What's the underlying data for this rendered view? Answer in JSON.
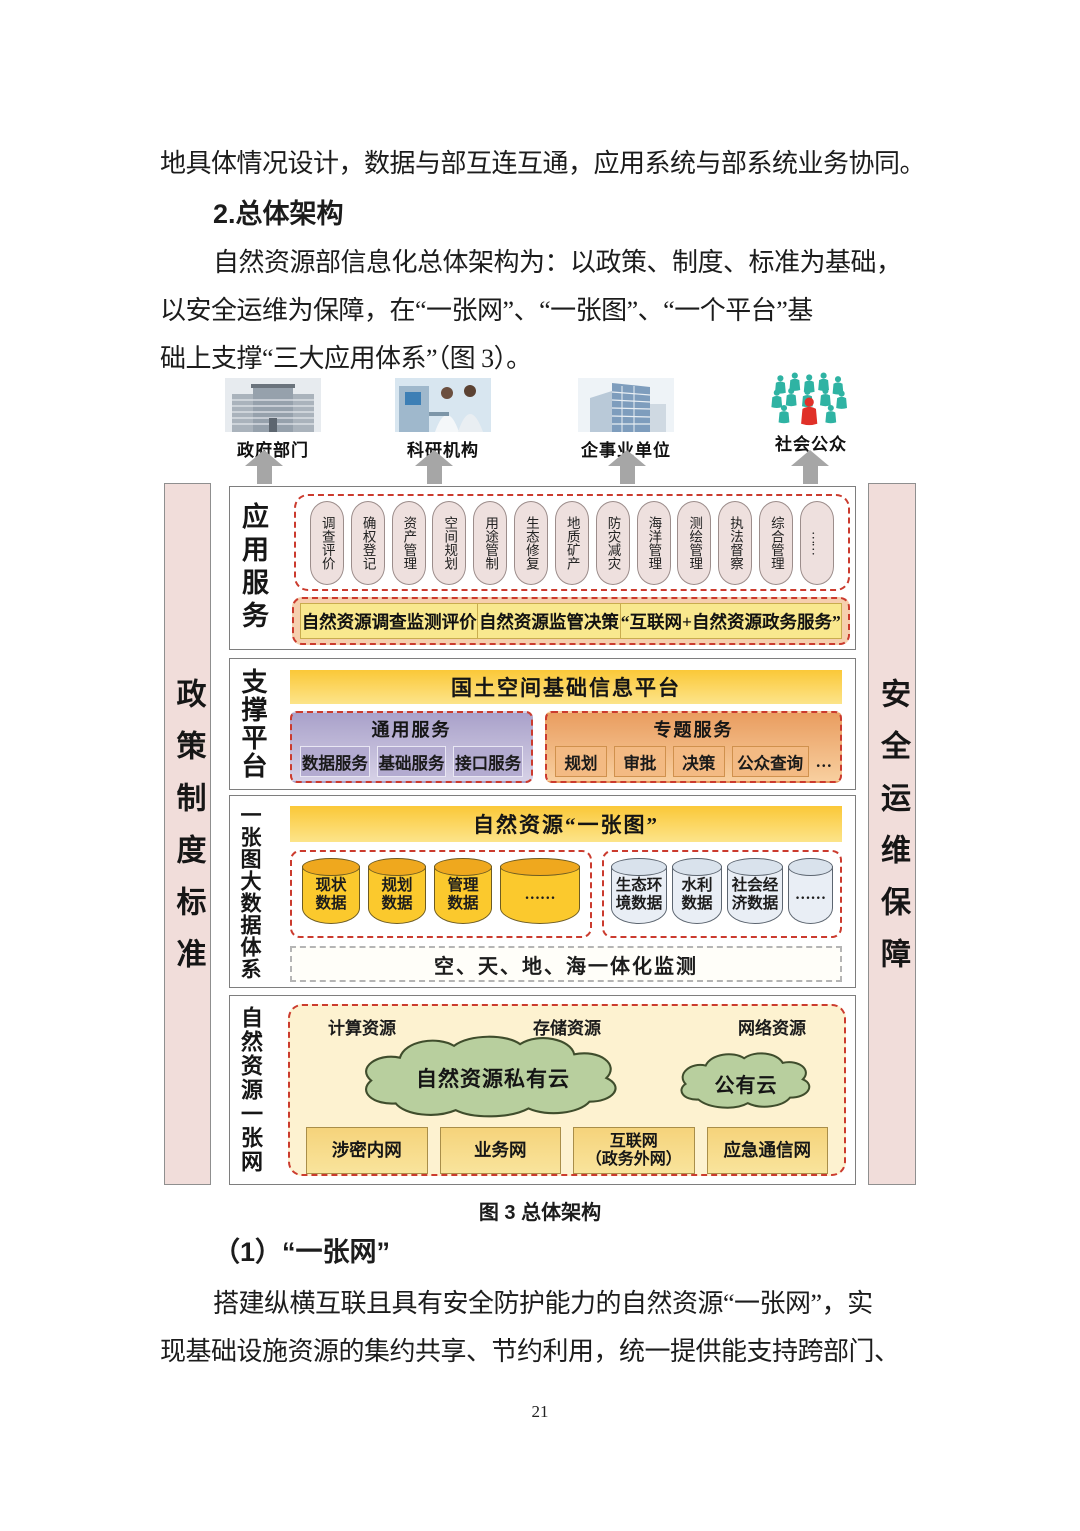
{
  "text": {
    "p1": "地具体情况设计，数据与部互连互通，应用系统与部系统业务协同。",
    "h1": "2.总体架构",
    "p2l1": "自然资源部信息化总体架构为：以政策、制度、标准为基础，",
    "p2l2": "以安全运维为保障，在“一张网”、“一张图”、“一个平台”基",
    "p2l3": "础上支撑“三大应用体系”（图 3）。",
    "caption": "图 3 总体架构",
    "h2": "（1）“一张网”",
    "p3l1": "搭建纵横互联且具有安全防护能力的自然资源“一张网”，实",
    "p3l2": "现基础设施资源的集约共享、节约利用，统一提供能支持跨部门、",
    "page_number": "21"
  },
  "diagram": {
    "users": [
      {
        "label": "政府部门"
      },
      {
        "label": "科研机构"
      },
      {
        "label": "企事业单位"
      },
      {
        "label": "社会公众"
      }
    ],
    "left_bar": "政策制度标准",
    "right_bar": "安全运维保障",
    "rows": {
      "app": {
        "label": "应用服务",
        "ovals": [
          "调查评价",
          "确权登记",
          "资产管理",
          "空间规划",
          "用途管制",
          "生态修复",
          "地质矿产",
          "防灾减灾",
          "海洋管理",
          "测绘管理",
          "执法督察",
          "综合管理",
          "……"
        ],
        "services": [
          "自然资源调查监测评价",
          "自然资源监管决策",
          "“互联网+自然资源政务服务”"
        ]
      },
      "platform": {
        "label": "支撑平台",
        "bar": "国土空间基础信息平台",
        "general": {
          "title": "通用服务",
          "items": [
            "数据服务",
            "基础服务",
            "接口服务"
          ]
        },
        "special": {
          "title": "专题服务",
          "items": [
            "规划",
            "审批",
            "决策",
            "公众查询"
          ],
          "more": "…"
        }
      },
      "map": {
        "label": "一张图大数据体系",
        "bar": "自然资源“一张图”",
        "core_data": [
          "现状\n数据",
          "规划\n数据",
          "管理\n数据",
          "……"
        ],
        "external_data": [
          "生态环\n境数据",
          "水利\n数据",
          "社会经\n济数据",
          "……"
        ],
        "monitor": "空、天、地、海一体化监测"
      },
      "network": {
        "label": "自然资源一张网",
        "resources": [
          "计算资源",
          "存储资源",
          "网络资源"
        ],
        "private_cloud": "自然资源私有云",
        "public_cloud": "公有云",
        "networks": [
          "涉密内网",
          "业务网",
          "互联网\n（政务外网）",
          "应急通信网"
        ]
      }
    }
  },
  "colors": {
    "red_dash": "#cb3b2e",
    "yellow_bar": "#fbc838",
    "pink_pillar": "#f1ddda",
    "purple_box": "#b3abd0",
    "orange_box": "#f3ba83",
    "green_cloud": "#b8cf9e"
  }
}
